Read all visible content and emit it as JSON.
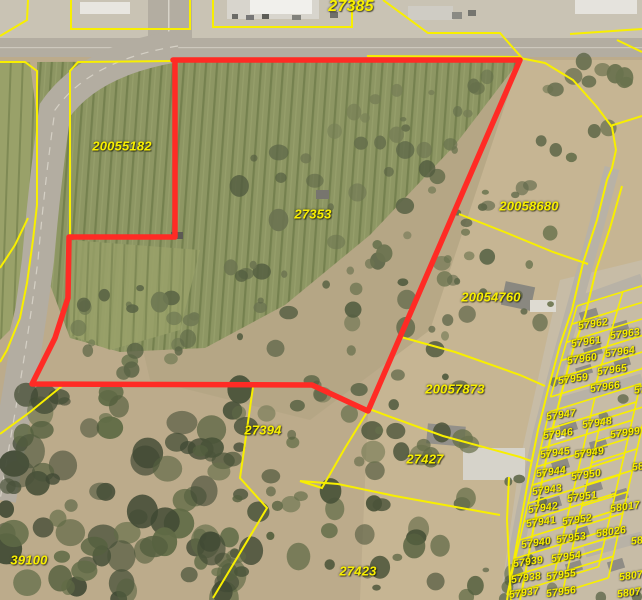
{
  "map": {
    "description": "GIS aerial parcel map with selected parcel outlined in red",
    "colors": {
      "parcel_line": "#f8ef00",
      "parcel_label": "#f8ef00",
      "selected_boundary": "#ff2b25"
    },
    "selected_parcel_boundary": [
      [
        173,
        60
      ],
      [
        520,
        60
      ],
      [
        368,
        411
      ],
      [
        312,
        385
      ],
      [
        32,
        384
      ],
      [
        55,
        338
      ],
      [
        64,
        310
      ],
      [
        68,
        298
      ],
      [
        69,
        237
      ],
      [
        175,
        237
      ],
      [
        175,
        60
      ]
    ],
    "parcel_lines": [
      {
        "id": "topleft-corner",
        "pts": [
          [
            28,
            0
          ],
          [
            27,
            20
          ],
          [
            0,
            36
          ]
        ]
      },
      {
        "id": "top-lot-1",
        "pts": [
          [
            71,
            0
          ],
          [
            71,
            29
          ],
          [
            190,
            29
          ],
          [
            190,
            0
          ]
        ]
      },
      {
        "id": "top-lot-2",
        "pts": [
          [
            213,
            0
          ],
          [
            213,
            27
          ],
          [
            352,
            27
          ],
          [
            352,
            0
          ]
        ]
      },
      {
        "id": "top-lot-3",
        "pts": [
          [
            383,
            0
          ],
          [
            428,
            33
          ],
          [
            500,
            33
          ],
          [
            522,
            58
          ]
        ]
      },
      {
        "id": "top-right-1",
        "pts": [
          [
            570,
            34
          ],
          [
            642,
            29
          ]
        ]
      },
      {
        "id": "top-right-2",
        "pts": [
          [
            617,
            40
          ],
          [
            642,
            52
          ]
        ]
      },
      {
        "id": "road-east-edge",
        "pts": [
          [
            0,
            62
          ],
          [
            25,
            62
          ],
          [
            37,
            71
          ],
          [
            37,
            205
          ],
          [
            33,
            240
          ],
          [
            27,
            283
          ],
          [
            20,
            318
          ],
          [
            7,
            350
          ],
          [
            0,
            362
          ]
        ]
      },
      {
        "id": "field-west-edge",
        "pts": [
          [
            173,
            61
          ],
          [
            78,
            62
          ],
          [
            70,
            71
          ],
          [
            70,
            237
          ]
        ]
      },
      {
        "id": "road-west-edge",
        "pts": [
          [
            28,
            218
          ],
          [
            15,
            245
          ],
          [
            0,
            268
          ]
        ]
      },
      {
        "id": "top-road-overlap",
        "pts": [
          [
            367,
            56
          ],
          [
            520,
            57
          ]
        ]
      },
      {
        "id": "street-west-edge",
        "pts": [
          [
            520,
            58
          ],
          [
            545,
            63
          ],
          [
            573,
            80
          ],
          [
            597,
            107
          ],
          [
            612,
            127
          ],
          [
            616,
            150
          ],
          [
            612,
            168
          ],
          [
            607,
            180
          ],
          [
            597,
            220
          ],
          [
            583,
            263
          ],
          [
            572,
            310
          ],
          [
            560,
            345
          ],
          [
            548,
            390
          ],
          [
            538,
            430
          ],
          [
            530,
            470
          ],
          [
            522,
            515
          ],
          [
            512,
            570
          ],
          [
            507,
            600
          ]
        ]
      },
      {
        "id": "street-east-edge",
        "pts": [
          [
            622,
            186
          ],
          [
            610,
            228
          ],
          [
            596,
            270
          ],
          [
            585,
            316
          ],
          [
            573,
            350
          ],
          [
            561,
            395
          ],
          [
            551,
            435
          ],
          [
            543,
            475
          ],
          [
            535,
            520
          ],
          [
            525,
            575
          ],
          [
            520,
            600
          ]
        ]
      },
      {
        "id": "ne-spur",
        "pts": [
          [
            610,
            126
          ],
          [
            642,
            116
          ]
        ]
      },
      {
        "id": "div-20058680-20054760",
        "pts": [
          [
            459,
            214
          ],
          [
            507,
            233
          ],
          [
            553,
            252
          ],
          [
            588,
            264
          ]
        ]
      },
      {
        "id": "div-20054760-20057873",
        "pts": [
          [
            401,
            337
          ],
          [
            455,
            352
          ],
          [
            520,
            375
          ],
          [
            545,
            386
          ]
        ]
      },
      {
        "id": "lot-27427-north",
        "pts": [
          [
            369,
            409
          ],
          [
            443,
            436
          ],
          [
            520,
            457
          ],
          [
            531,
            461
          ]
        ]
      },
      {
        "id": "lot-27427-west-south",
        "pts": [
          [
            369,
            409
          ],
          [
            345,
            448
          ],
          [
            322,
            488
          ],
          [
            300,
            481
          ],
          [
            338,
            484
          ],
          [
            395,
            496
          ],
          [
            500,
            515
          ]
        ]
      },
      {
        "id": "row-line-510",
        "pts": [
          [
            509,
            477
          ],
          [
            507,
            520
          ],
          [
            511,
            600
          ]
        ]
      },
      {
        "id": "west-zigzag",
        "pts": [
          [
            253,
            387
          ],
          [
            240,
            478
          ],
          [
            267,
            508
          ],
          [
            213,
            598
          ]
        ]
      },
      {
        "id": "div-39100-road",
        "pts": [
          [
            62,
            386
          ],
          [
            30,
            412
          ],
          [
            0,
            434
          ]
        ]
      }
    ],
    "lot_grids": [
      {
        "id": "block-57959-57966",
        "origin": [
          577,
          306
        ],
        "u": [
          45.8,
          -14.2
        ],
        "v": [
          -5.3,
          18.2
        ],
        "cols": 2,
        "rows": 5
      },
      {
        "id": "block-57937-57956",
        "origin": [
          549,
          412
        ],
        "u": [
          45.8,
          -14.2
        ],
        "v": [
          -4.2,
          18.3
        ],
        "cols": 2,
        "rows": 10
      },
      {
        "id": "block-east-58000s",
        "origin": [
          601,
          420
        ],
        "u": [
          45.8,
          -14.2
        ],
        "v": [
          -4.8,
          21.5
        ],
        "cols": 1,
        "rows": 8
      }
    ],
    "labels": [
      {
        "t": "27385",
        "x": 351,
        "y": 7,
        "s": "xl"
      },
      {
        "t": "20055182",
        "x": 122,
        "y": 146,
        "s": "lg"
      },
      {
        "t": "27353",
        "x": 313,
        "y": 214,
        "s": "lg"
      },
      {
        "t": "20058680",
        "x": 529,
        "y": 206,
        "s": "lg"
      },
      {
        "t": "20054760",
        "x": 491,
        "y": 297,
        "s": "lg"
      },
      {
        "t": "20057873",
        "x": 455,
        "y": 389,
        "s": "lg"
      },
      {
        "t": "27394",
        "x": 263,
        "y": 430,
        "s": "lg"
      },
      {
        "t": "27427",
        "x": 425,
        "y": 459,
        "s": "lg"
      },
      {
        "t": "39100",
        "x": 29,
        "y": 560,
        "s": "lg"
      },
      {
        "t": "27423",
        "x": 358,
        "y": 571,
        "s": "lg"
      },
      {
        "t": "57962",
        "x": 593,
        "y": 324,
        "s": "sm"
      },
      {
        "t": "57963",
        "x": 625,
        "y": 334,
        "s": "sm"
      },
      {
        "t": "57961",
        "x": 586,
        "y": 342,
        "s": "sm"
      },
      {
        "t": "57964",
        "x": 620,
        "y": 352,
        "s": "sm"
      },
      {
        "t": "57960",
        "x": 582,
        "y": 359,
        "s": "sm"
      },
      {
        "t": "57965",
        "x": 612,
        "y": 370,
        "s": "sm"
      },
      {
        "t": "57959",
        "x": 573,
        "y": 379,
        "s": "sm"
      },
      {
        "t": "57966",
        "x": 605,
        "y": 387,
        "s": "sm"
      },
      {
        "t": "57",
        "x": 640,
        "y": 390,
        "s": "sm"
      },
      {
        "t": "57947",
        "x": 561,
        "y": 415,
        "s": "sm"
      },
      {
        "t": "57948",
        "x": 597,
        "y": 423,
        "s": "sm"
      },
      {
        "t": "57999",
        "x": 625,
        "y": 433,
        "s": "sm"
      },
      {
        "t": "57946",
        "x": 558,
        "y": 434,
        "s": "sm"
      },
      {
        "t": "57945",
        "x": 555,
        "y": 453,
        "s": "sm"
      },
      {
        "t": "57949",
        "x": 589,
        "y": 453,
        "s": "sm"
      },
      {
        "t": "57944",
        "x": 551,
        "y": 472,
        "s": "sm"
      },
      {
        "t": "57950",
        "x": 586,
        "y": 475,
        "s": "sm"
      },
      {
        "t": "58",
        "x": 638,
        "y": 467,
        "s": "sm"
      },
      {
        "t": "57943",
        "x": 547,
        "y": 490,
        "s": "sm"
      },
      {
        "t": "57951",
        "x": 582,
        "y": 497,
        "s": "sm"
      },
      {
        "t": "57942",
        "x": 543,
        "y": 508,
        "s": "sm"
      },
      {
        "t": "58017",
        "x": 625,
        "y": 507,
        "s": "sm"
      },
      {
        "t": "57941",
        "x": 541,
        "y": 522,
        "s": "sm"
      },
      {
        "t": "57952",
        "x": 577,
        "y": 520,
        "s": "sm"
      },
      {
        "t": "58026",
        "x": 611,
        "y": 532,
        "s": "sm"
      },
      {
        "t": "58",
        "x": 637,
        "y": 541,
        "s": "sm"
      },
      {
        "t": "57940",
        "x": 536,
        "y": 543,
        "s": "sm"
      },
      {
        "t": "57953",
        "x": 571,
        "y": 538,
        "s": "sm"
      },
      {
        "t": "57954",
        "x": 566,
        "y": 557,
        "s": "sm"
      },
      {
        "t": "57939",
        "x": 528,
        "y": 562,
        "s": "sm"
      },
      {
        "t": "57955",
        "x": 561,
        "y": 575,
        "s": "sm"
      },
      {
        "t": "57938",
        "x": 526,
        "y": 578,
        "s": "sm"
      },
      {
        "t": "5807",
        "x": 631,
        "y": 576,
        "s": "sm"
      },
      {
        "t": "57956",
        "x": 561,
        "y": 592,
        "s": "sm"
      },
      {
        "t": "57937",
        "x": 524,
        "y": 593,
        "s": "sm"
      },
      {
        "t": "5807",
        "x": 629,
        "y": 593,
        "s": "sm"
      }
    ]
  }
}
